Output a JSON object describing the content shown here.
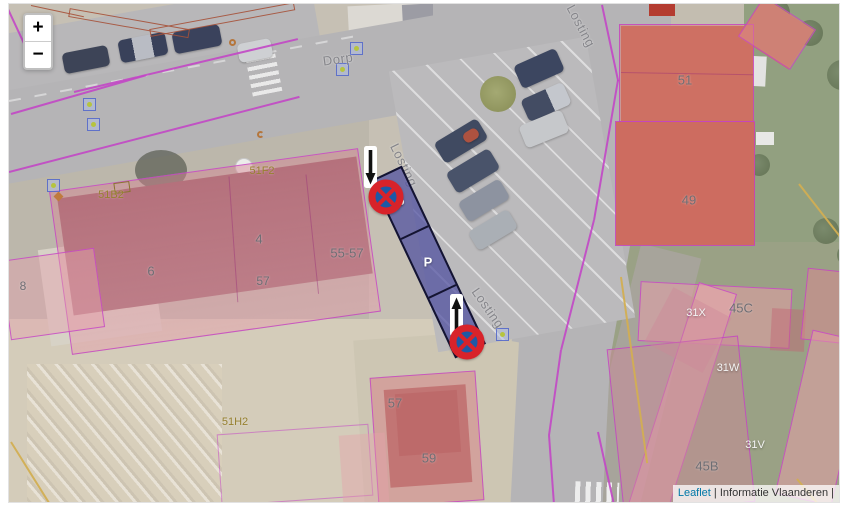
{
  "zoom_control": {
    "zoom_in": "+",
    "zoom_out": "−"
  },
  "attribution": {
    "leaflet_link": "Leaflet",
    "separator": "|",
    "provider": "Informatie Vlaanderen",
    "trailing_separator": "|"
  },
  "street_labels": [
    {
      "text": "Dorp",
      "x": 329,
      "y": 55,
      "rotate": -8
    },
    {
      "text": "Losting",
      "x": 572,
      "y": 22,
      "rotate": 62
    },
    {
      "text": "Losting",
      "x": 395,
      "y": 161,
      "rotate": 64
    },
    {
      "text": "Losting",
      "x": 479,
      "y": 304,
      "rotate": 55
    }
  ],
  "parcel_labels": [
    {
      "text": "4",
      "x": 250,
      "y": 235,
      "color": "gray",
      "size": 13
    },
    {
      "text": "6",
      "x": 142,
      "y": 267,
      "color": "gray",
      "size": 13
    },
    {
      "text": "8",
      "x": 14,
      "y": 282,
      "color": "gray",
      "size": 12
    },
    {
      "text": "55-57",
      "x": 338,
      "y": 249,
      "color": "gray",
      "size": 13
    },
    {
      "text": "57",
      "x": 254,
      "y": 277,
      "color": "gray",
      "size": 12
    },
    {
      "text": "57",
      "x": 386,
      "y": 399,
      "color": "gray",
      "size": 13
    },
    {
      "text": "59",
      "x": 420,
      "y": 454,
      "color": "gray",
      "size": 13
    },
    {
      "text": "51",
      "x": 676,
      "y": 76,
      "color": "gray",
      "size": 13
    },
    {
      "text": "49",
      "x": 680,
      "y": 196,
      "color": "gray",
      "size": 13
    },
    {
      "text": "45C",
      "x": 732,
      "y": 304,
      "color": "gray",
      "size": 13
    },
    {
      "text": "45B",
      "x": 698,
      "y": 462,
      "color": "gray",
      "size": 13
    },
    {
      "text": "51B2",
      "x": 102,
      "y": 191,
      "color": "olive",
      "size": 11
    },
    {
      "text": "51F2",
      "x": 253,
      "y": 167,
      "color": "olive",
      "size": 11
    },
    {
      "text": "51H2",
      "x": 226,
      "y": 418,
      "color": "olive",
      "size": 11
    },
    {
      "text": "31X",
      "x": 687,
      "y": 309,
      "color": "white",
      "size": 11
    },
    {
      "text": "31W",
      "x": 719,
      "y": 364,
      "color": "white",
      "size": 11
    },
    {
      "text": "31V",
      "x": 746,
      "y": 441,
      "color": "white",
      "size": 11
    }
  ],
  "parking_zone": {
    "cells": [
      "P",
      "P",
      "P"
    ]
  },
  "signs": [
    {
      "type": "no-stopping-sign",
      "x": 377,
      "y": 193
    },
    {
      "type": "no-stopping-sign",
      "x": 458,
      "y": 338
    }
  ],
  "arrows": [
    {
      "direction": "down",
      "x": 361,
      "y": 163
    },
    {
      "direction": "up",
      "x": 447,
      "y": 311
    }
  ],
  "address_points": [
    {
      "x": 347,
      "y": 44
    },
    {
      "x": 333,
      "y": 65
    },
    {
      "x": 80,
      "y": 100
    },
    {
      "x": 84,
      "y": 120
    },
    {
      "x": 44,
      "y": 181
    },
    {
      "x": 493,
      "y": 330
    }
  ],
  "poi_points": [
    {
      "shape": "ring",
      "x": 224,
      "y": 39
    },
    {
      "shape": "diamond",
      "x": 50,
      "y": 193
    },
    {
      "shape": "arc",
      "x": 252,
      "y": 131
    },
    {
      "shape": "rect",
      "x": 113,
      "y": 184
    }
  ],
  "colors": {
    "parking_fill": "rgba(77,77,160,0.72)",
    "parking_border": "#141432",
    "sign_red": "#d8232a",
    "sign_blue": "#1d59a6",
    "parcel_pink": "rgba(216,128,140,0.5)",
    "parcel_border": "#c33fc7",
    "road_gray": "#b5b4b6",
    "attribution_link_blue": "#0078A8"
  }
}
